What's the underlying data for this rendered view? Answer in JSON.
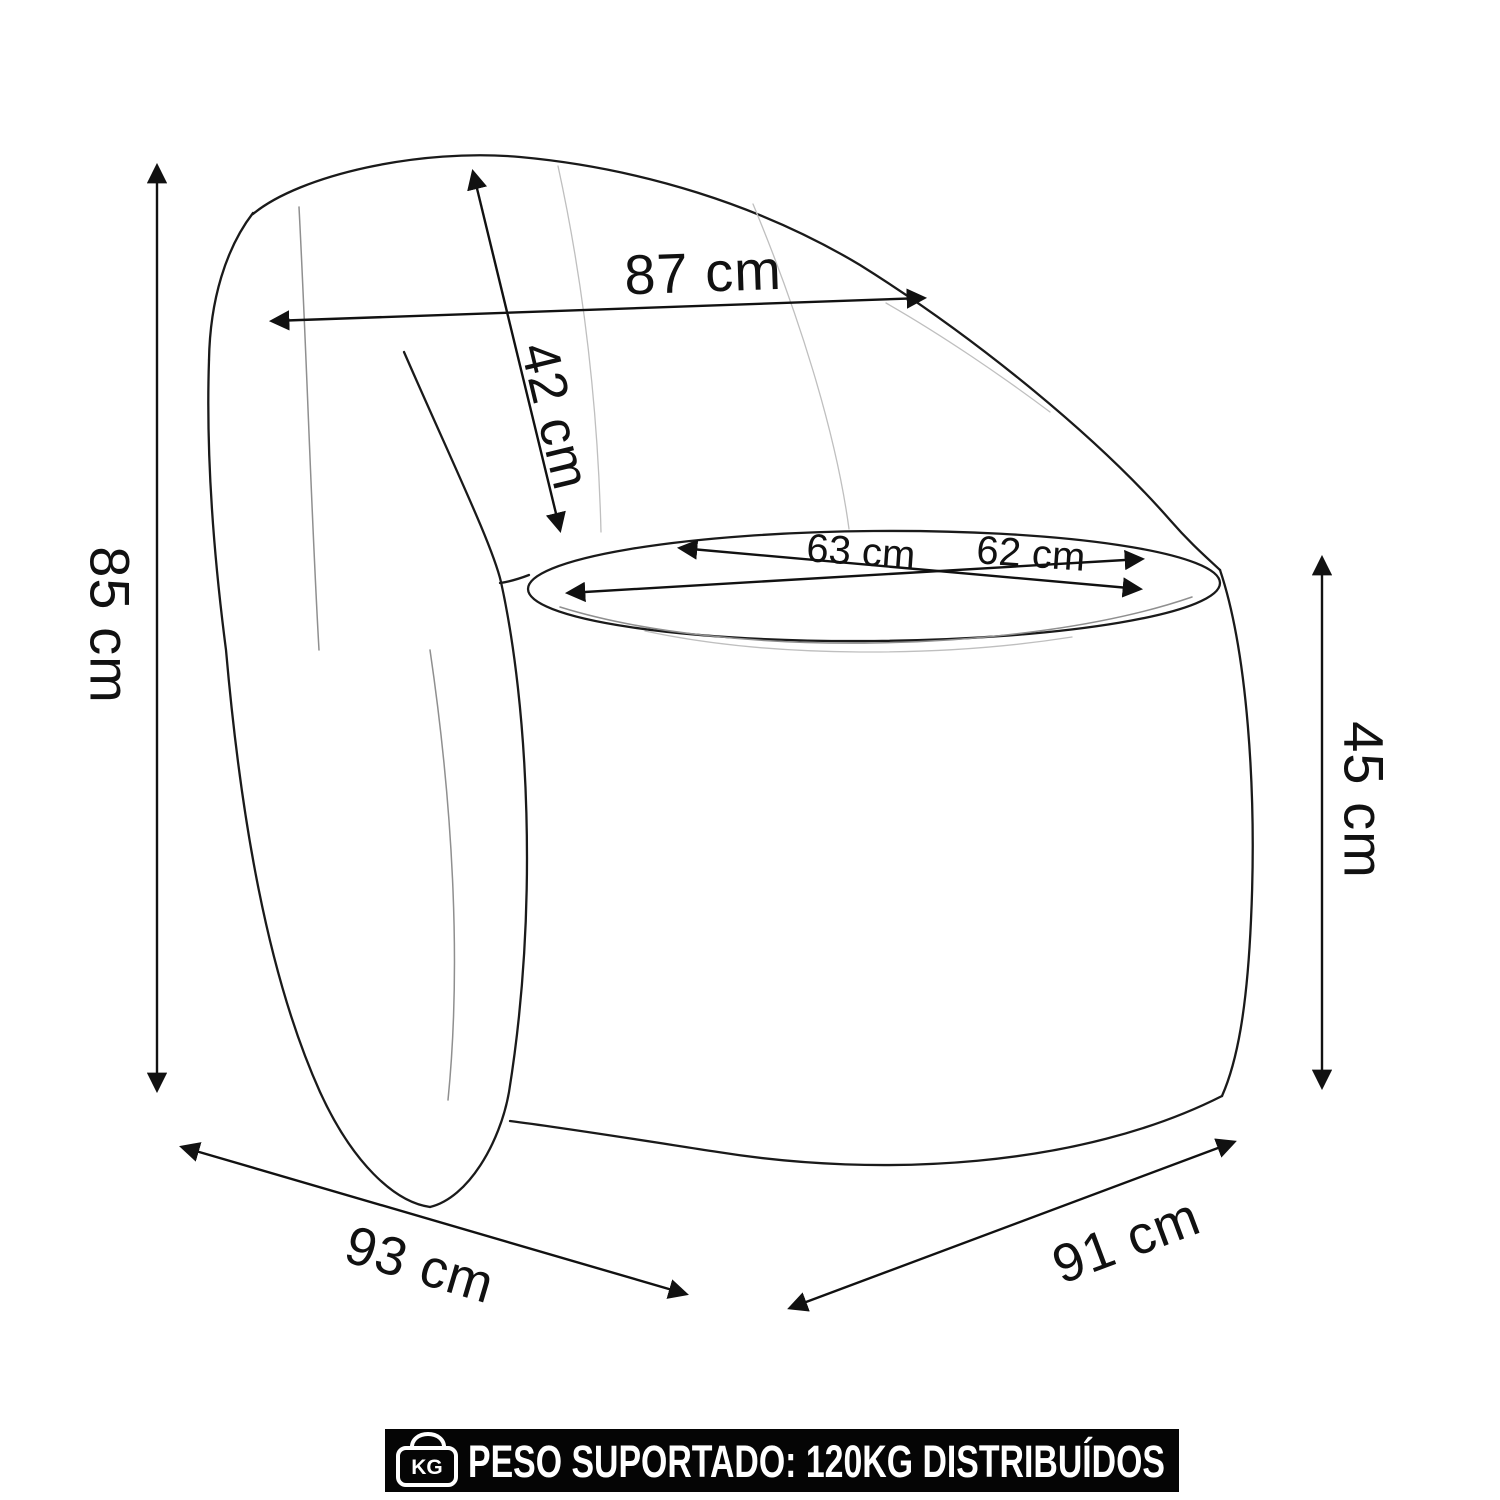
{
  "diagram": {
    "type": "armchair-dimension-diagram",
    "labels": {
      "total_height": "85 cm",
      "back_width": "87 cm",
      "backrest_height": "42 cm",
      "seat_width": "63 cm",
      "seat_depth": "62 cm",
      "seat_height": "45 cm",
      "total_depth": "93 cm",
      "total_width": "91 cm"
    },
    "banner": {
      "icon": "weight-kg-icon",
      "icon_label": "KG",
      "text": "PESO SUPORTADO: 120KG DISTRIBUÍDOS"
    },
    "colors": {
      "background": "#ffffff",
      "line": "#1a1a1a",
      "dimension_line": "#111111",
      "seam_light": "#bfbfbf",
      "seam_medium": "#8f8f8f",
      "banner_bg": "#050505",
      "banner_text": "#ffffff"
    }
  }
}
